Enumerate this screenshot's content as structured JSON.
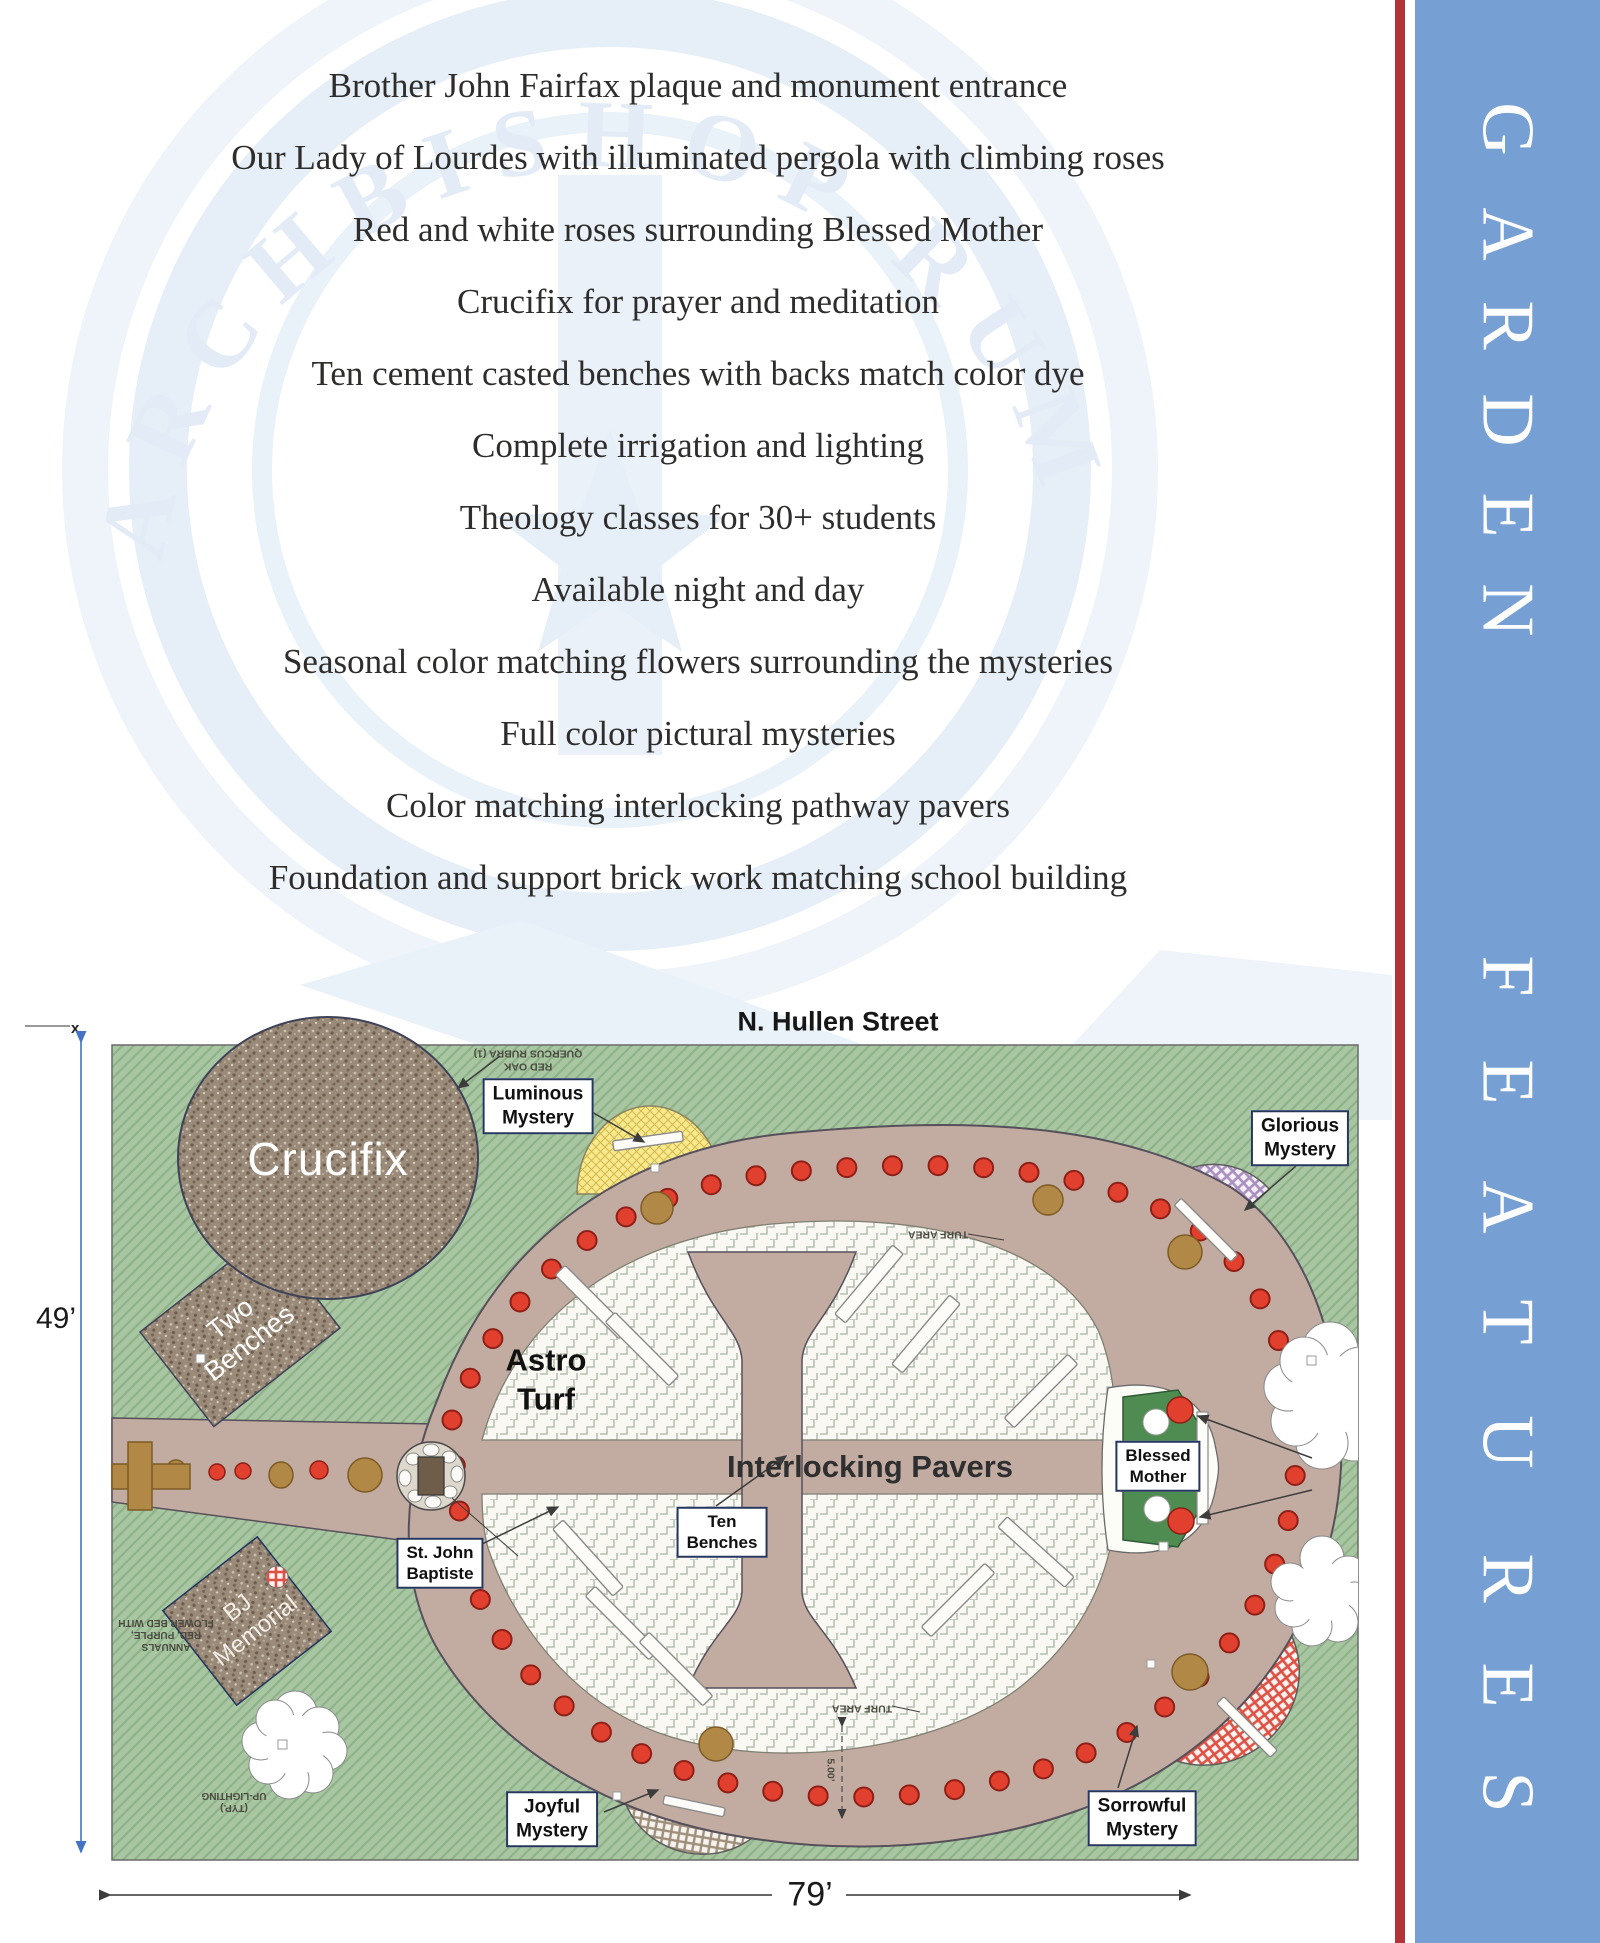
{
  "sidebar": {
    "title": "GARDEN FEATURES",
    "garden": [
      "G",
      "A",
      "R",
      "D",
      "E",
      "N"
    ],
    "features": [
      "F",
      "E",
      "A",
      "T",
      "U",
      "R",
      "E",
      "S"
    ],
    "bar_color": "#769fd3",
    "stripe_color": "#b23338"
  },
  "features_list": [
    "Brother John Fairfax plaque and monument entrance",
    "Our Lady of Lourdes with illuminated pergola with climbing roses",
    "Red and white roses surrounding Blessed Mother",
    "Crucifix for prayer and meditation",
    "Ten cement casted benches with backs match color dye",
    "Complete irrigation and lighting",
    "Theology classes for 30+ students",
    "Available night and day",
    "Seasonal color matching flowers surrounding the mysteries",
    "Full color pictural mysteries",
    "Color matching interlocking pathway pavers",
    "Foundation and support brick work matching school building"
  ],
  "map": {
    "street": "N. Hullen Street",
    "height_dim": "49’",
    "width_dim": "79’",
    "area_labels": {
      "crucifix": "Crucifix",
      "two_benches": [
        "Two",
        "Benches"
      ],
      "bj_memorial": [
        "BJ",
        "Memorial"
      ],
      "astro_turf": [
        "Astro",
        "Turf"
      ],
      "pavers": "Interlocking Pavers"
    },
    "boxes": {
      "luminous": [
        "Luminous",
        "Mystery"
      ],
      "glorious": [
        "Glorious",
        "Mystery"
      ],
      "blessed": [
        "Blessed",
        "Mother"
      ],
      "ten_benches": [
        "Ten",
        "Benches"
      ],
      "st_john": [
        "St. John",
        "Baptiste"
      ],
      "joyful": [
        "Joyful",
        "Mystery"
      ],
      "sorrowful": [
        "Sorrowful",
        "Mystery"
      ]
    },
    "annotations": {
      "quercus": [
        "QUERCUS RUBRA (1)",
        "RED OAK"
      ],
      "turf_area": "TURF AREA",
      "flower_bed": [
        "FLOWER BED WITH",
        "RED, PURPLE,",
        "ANNUALS"
      ],
      "uplighting": [
        "UP-LIGHTING",
        "(TYP.)"
      ],
      "spacing": "5.00’"
    },
    "beads": {
      "count": 52,
      "color": "#e2402f",
      "stroke": "#8e1f16"
    },
    "colors": {
      "grass": "#a8c6a2",
      "path": "#c2aca2",
      "turf": "#f9f8f2",
      "dim_blue": "#4472c4"
    }
  }
}
